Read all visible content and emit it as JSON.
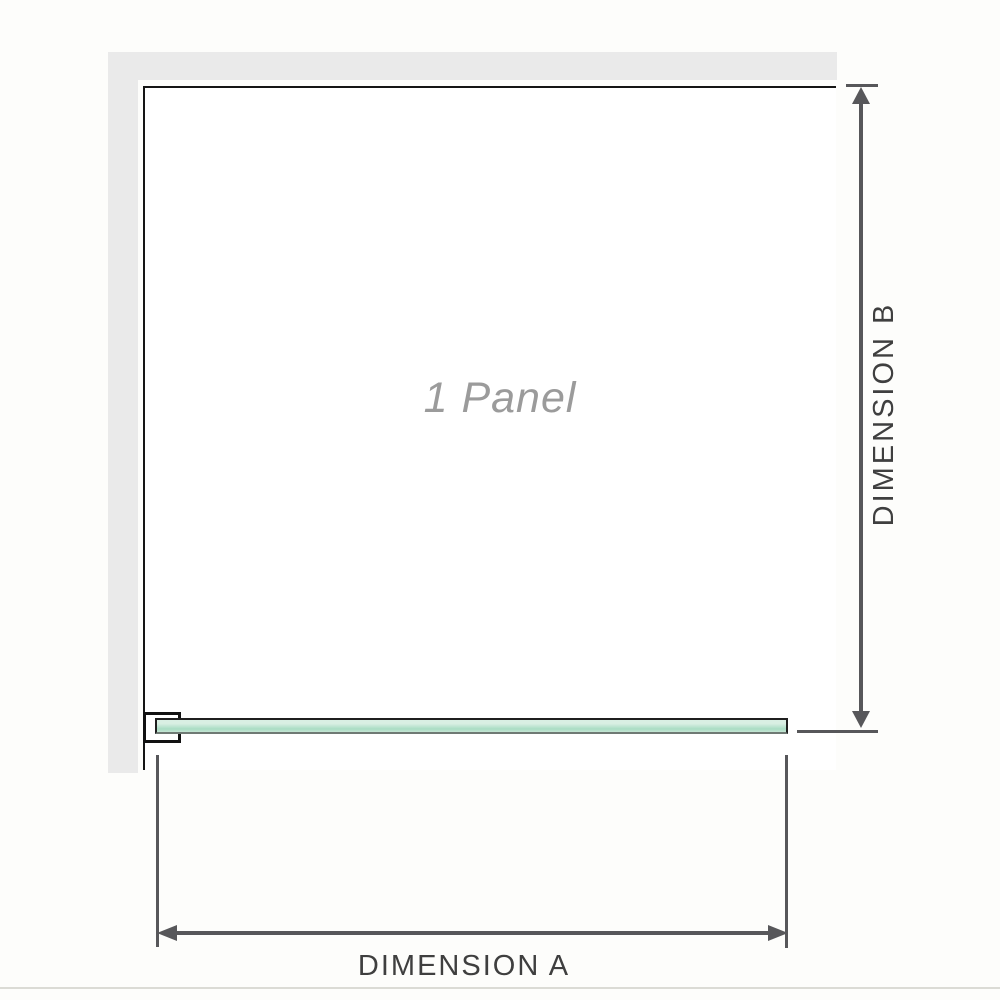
{
  "diagram": {
    "panel_label": "1 Panel",
    "dimension_a": {
      "label": "DIMENSION A",
      "axis": "horizontal"
    },
    "dimension_b": {
      "label": "DIMENSION B",
      "axis": "vertical"
    }
  },
  "colors": {
    "background": "#fdfdfb",
    "wall_fill": "#eaeaea",
    "panel_border": "#151515",
    "panel_fill": "#ffffff",
    "panel_label_text": "#9b9b9b",
    "glass_fill_light": "#d9efe3",
    "glass_fill_mid": "#a9dcc3",
    "glass_border": "#1f1f1f",
    "bracket_border": "#111111",
    "dimension_line": "#57575a",
    "dimension_text": "#3f3f3f",
    "image_edge_line": "#dbdbd5"
  }
}
